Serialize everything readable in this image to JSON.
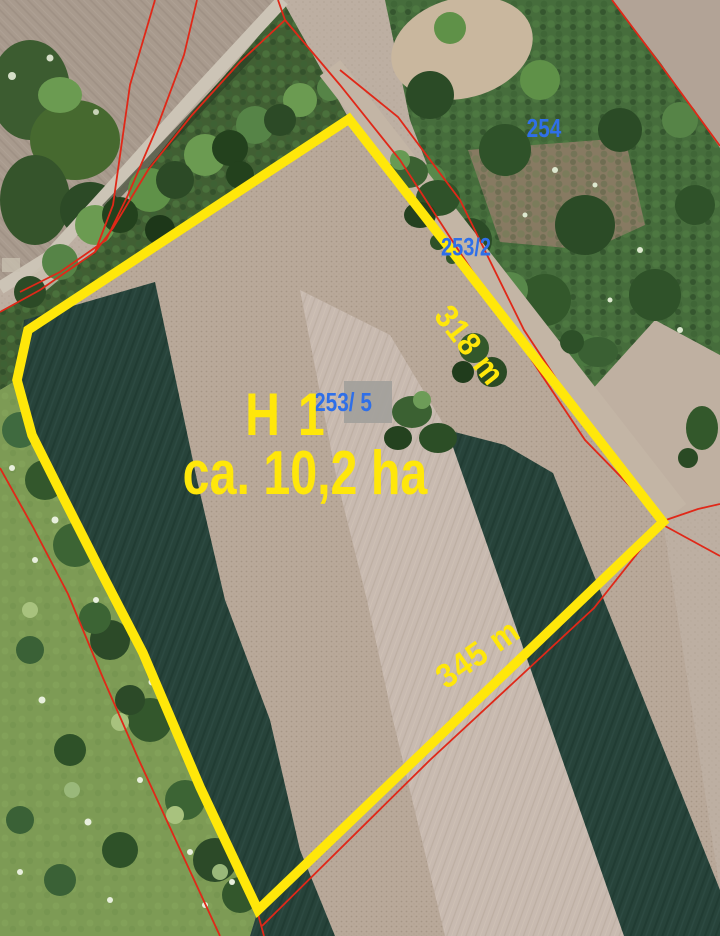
{
  "map": {
    "highlighted_area": {
      "name": "H 1",
      "area": "ca. 10,2 ha"
    },
    "parcel_numbers": [
      {
        "label": "254"
      },
      {
        "label": "253/2"
      },
      {
        "label": "253/ 5"
      }
    ],
    "edge_lengths": [
      {
        "label": "318 m"
      },
      {
        "label": "345 m"
      }
    ]
  },
  "colors": {
    "highlight_yellow": "#ffe70a",
    "boundary_red": "#e02818",
    "parcel_number_blue": "#2f6fe8",
    "info_box_gray": "#a3a09b"
  }
}
